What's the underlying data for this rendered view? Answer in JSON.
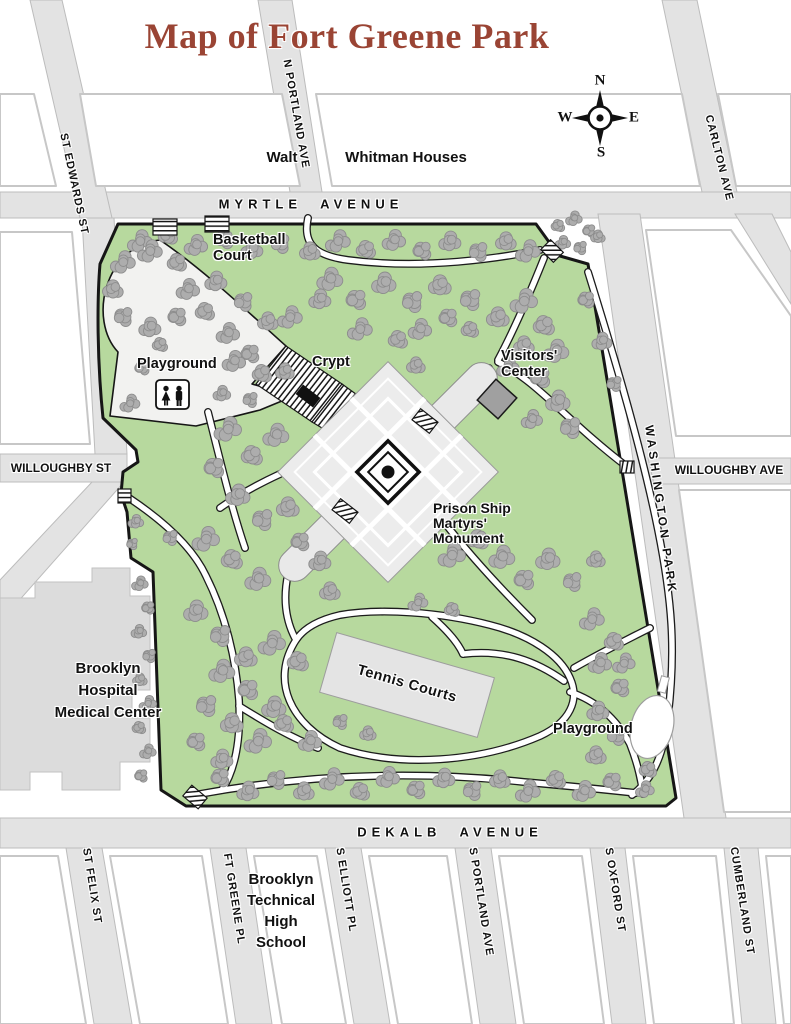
{
  "title": "Map of Fort Greene Park",
  "compass": {
    "n": "N",
    "e": "E",
    "s": "S",
    "w": "W"
  },
  "streets": {
    "myrtle": "MYRTLE AVENUE",
    "dekalb": "DEKALB AVENUE",
    "st_edwards": "ST EDWARDS ST",
    "n_portland": "N PORTLAND AVE",
    "carlton": "CARLTON AVE",
    "washington_park": "WASHINGTON PARK",
    "willoughby_st": "WILLOUGHBY ST",
    "willoughby_ave": "WILLOUGHBY AVE",
    "st_felix": "ST FELIX ST",
    "ft_greene": "FT GREENE PL",
    "s_elliott": "S ELLIOTT PL",
    "s_portland": "S PORTLAND AVE",
    "s_oxford": "S OXFORD ST",
    "cumberland": "CUMBERLAND ST"
  },
  "places": {
    "walt": "Walt",
    "whitman": "Whitman Houses",
    "basketball": {
      "line1": "Basketball",
      "line2": "Court"
    },
    "playground_nw": "Playground",
    "crypt": "Crypt",
    "visitors": {
      "line1": "Visitors'",
      "line2": "Center"
    },
    "monument": {
      "line1": "Prison Ship",
      "line2": "Martyrs'",
      "line3": "Monument"
    },
    "tennis": "Tennis Courts",
    "playground_se": "Playground",
    "hospital": {
      "line1": "Brooklyn",
      "line2": "Hospital",
      "line3": "Medical Center"
    },
    "high_school": {
      "line1": "Brooklyn",
      "line2": "Technical",
      "line3": "High",
      "line4": "School"
    }
  },
  "colors": {
    "title": "#9a4434",
    "park_green": "#b7d99e",
    "tree_gray": "#adadad",
    "road_gray": "#e3e3e3",
    "building_gray": "#dcdcdc",
    "monument_gray": "#ececec"
  }
}
